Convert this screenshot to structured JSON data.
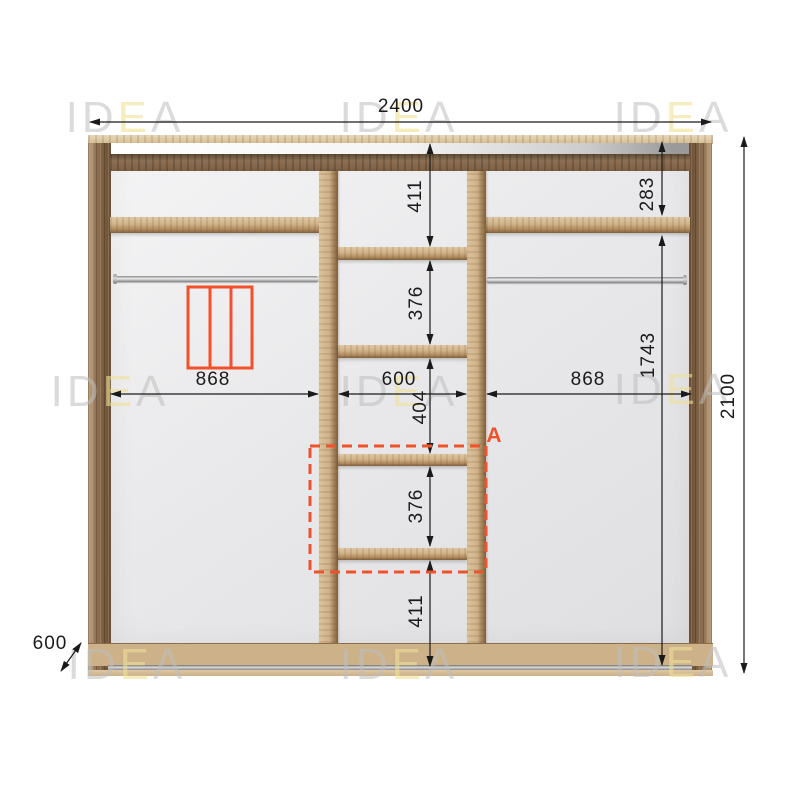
{
  "watermark": {
    "part1": "ID",
    "part2": "E",
    "part3": "A"
  },
  "dimensions": {
    "total_width": "2400",
    "total_height": "2100",
    "depth": "600",
    "left_section_width": "868",
    "center_section_width": "600",
    "right_section_width": "868",
    "center_shelf_gaps": [
      "411",
      "376",
      "404",
      "376",
      "411"
    ],
    "right_top_gap": "283",
    "right_lower_height": "1743"
  },
  "annotations": {
    "section_label": "A"
  },
  "colors": {
    "accent_orange": "#f2512a",
    "dimension_line": "#1a1a1a",
    "wood_light": "#cfb189",
    "wood_dark": "#7c5f41",
    "watermark_gray": "#d6d6d6",
    "watermark_yellow": "#efe7bb"
  }
}
